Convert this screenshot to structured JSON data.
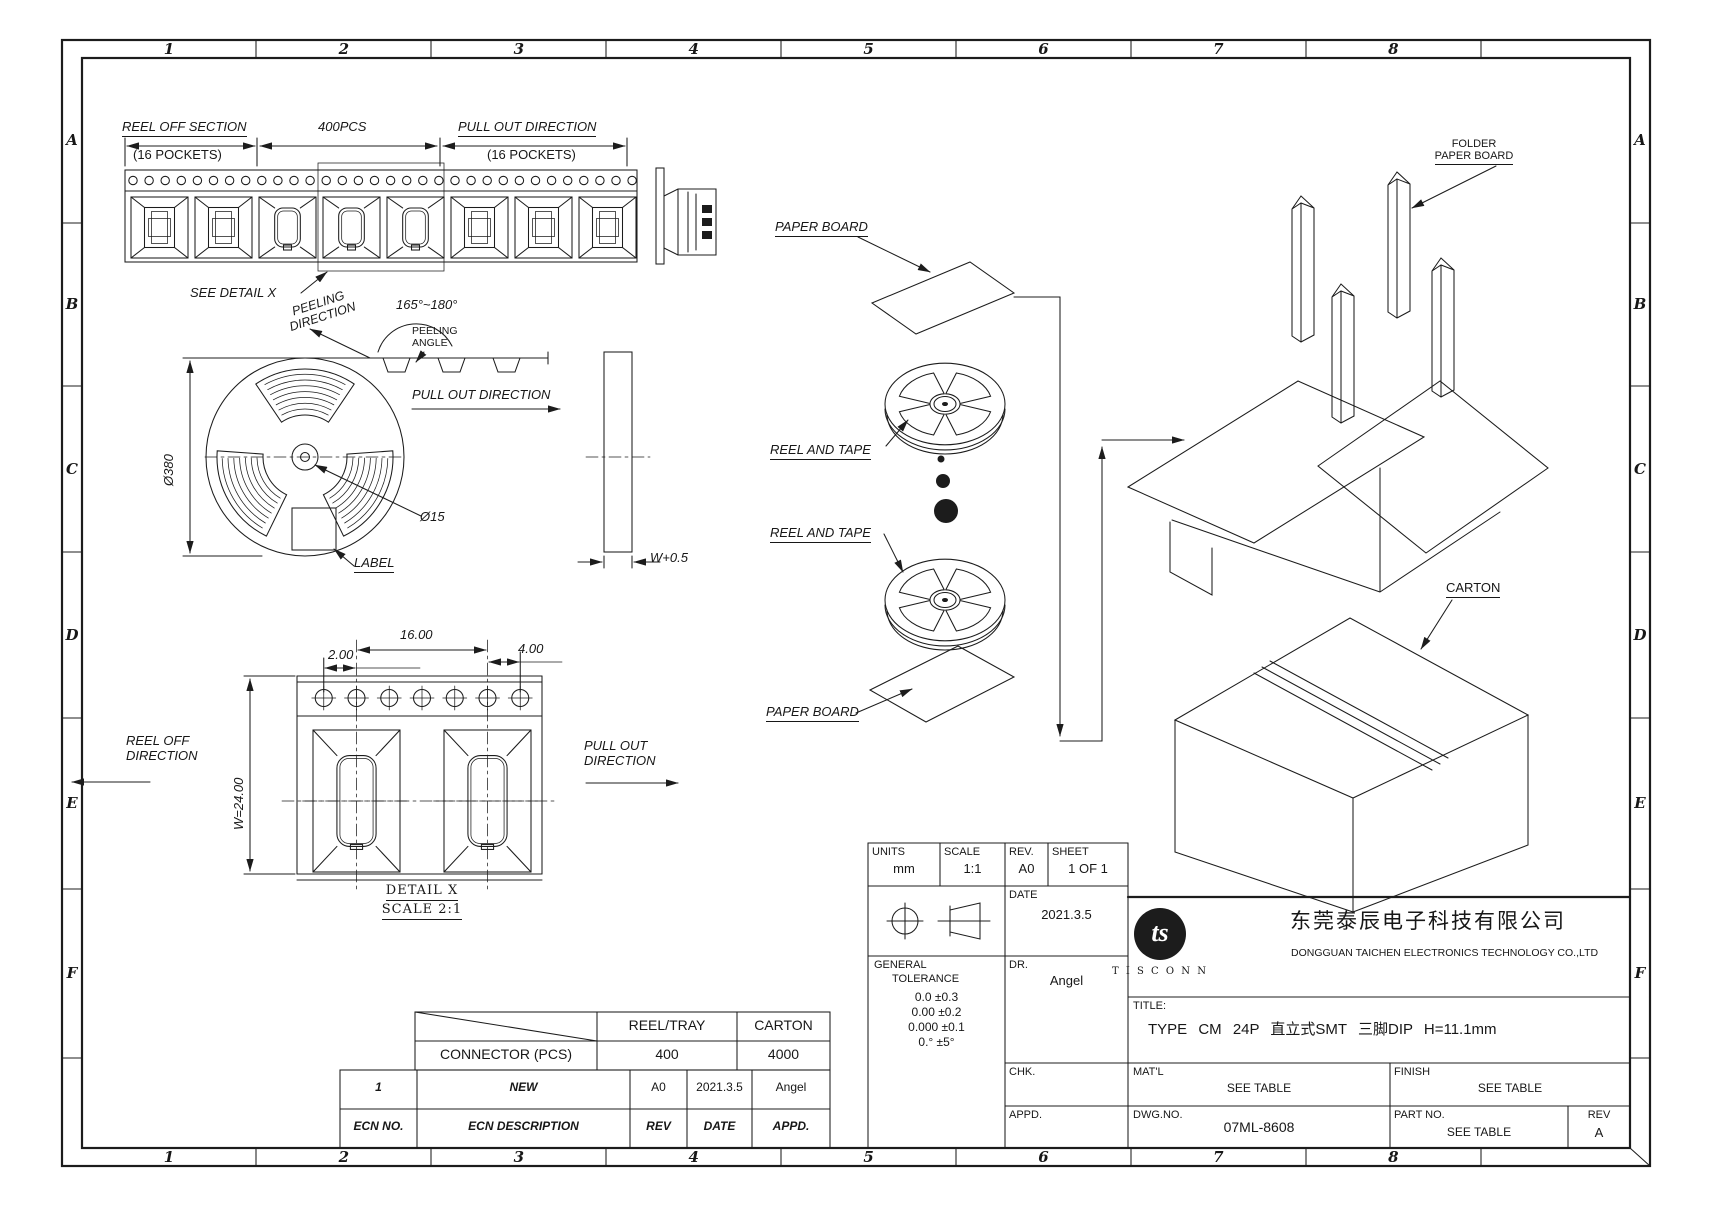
{
  "drawing": {
    "zones": {
      "cols": [
        "1",
        "2",
        "3",
        "4",
        "5",
        "6",
        "7",
        "8"
      ],
      "rows": [
        "A",
        "B",
        "C",
        "D",
        "E",
        "F"
      ]
    },
    "strip": {
      "reel_off_section": "REEL OFF SECTION",
      "pockets_16": "(16 POCKETS)",
      "qty": "400PCS",
      "pull_out_direction": "PULL OUT DIRECTION",
      "see_detail": "SEE DETAIL X"
    },
    "reel": {
      "peeling_1": "PEELING",
      "peeling_2": "DIRECTION",
      "angle_range": "165°~180°",
      "peeling_angle_1": "PEELING",
      "peeling_angle_2": "ANGLE",
      "pull_out": "PULL OUT DIRECTION",
      "dia_reel": "Ø380",
      "dia_hub": "Ø15",
      "label": "LABEL",
      "side_width": "W+0.5"
    },
    "detail": {
      "dim_pitch": "16.00",
      "dim_hole": "2.00",
      "dim_offset": "4.00",
      "dim_width": "W=24.00",
      "reel_off_1": "REEL OFF",
      "reel_off_2": "DIRECTION",
      "pull_out_1": "PULL OUT",
      "pull_out_2": "DIRECTION",
      "caption": "DETAIL X",
      "caption_scale": "SCALE 2:1"
    },
    "packing": {
      "paper_board": "PAPER BOARD",
      "reel_and_tape": "REEL AND TAPE",
      "folder_1": "FOLDER",
      "folder_2": "PAPER BOARD",
      "carton": "CARTON"
    }
  },
  "qty_table": {
    "col_reel": "REEL/TRAY",
    "col_carton": "CARTON",
    "row_label": "CONNECTOR (PCS)",
    "reel_qty": "400",
    "carton_qty": "4000"
  },
  "ecn_table": {
    "entry_no": "1",
    "entry_desc": "NEW",
    "entry_rev": "A0",
    "entry_date": "2021.3.5",
    "entry_appd": "Angel",
    "h_no": "ECN NO.",
    "h_desc": "ECN  DESCRIPTION",
    "h_rev": "REV",
    "h_date": "DATE",
    "h_appd": "APPD."
  },
  "title_block": {
    "units_label": "UNITS",
    "units": "mm",
    "scale_label": "SCALE",
    "scale": "1:1",
    "rev_label": "REV.",
    "rev": "A0",
    "sheet_label": "SHEET",
    "sheet": "1 OF 1",
    "date_label": "DATE",
    "date": "2021.3.5",
    "dr_label": "DR.",
    "dr": "Angel",
    "chk_label": "CHK.",
    "appd_label": "APPD.",
    "tol_title1": "GENERAL",
    "tol_title2": "TOLERANCE",
    "tol1": "0.0   ±0.3",
    "tol2": "0.00  ±0.2",
    "tol3": "0.000 ±0.1",
    "tol4": "0.°   ±5°",
    "logo_monogram": "ts",
    "company_logo": "T I S C O N N",
    "company_cn": "东莞泰辰电子科技有限公司",
    "company_en": "DONGGUAN TAICHEN ELECTRONICS TECHNOLOGY CO.,LTD",
    "title_label": "TITLE:",
    "title": "TYPE CM 24P 直立式SMT 三脚DIP H=11.1mm",
    "matl_label": "MAT'L",
    "matl": "SEE TABLE",
    "finish_label": "FINISH",
    "finish": "SEE TABLE",
    "dwg_label": "DWG.NO.",
    "dwg_no": "07ML-8608",
    "part_label": "PART NO.",
    "part_no": "SEE TABLE",
    "rev2_label": "REV",
    "rev2": "A"
  }
}
